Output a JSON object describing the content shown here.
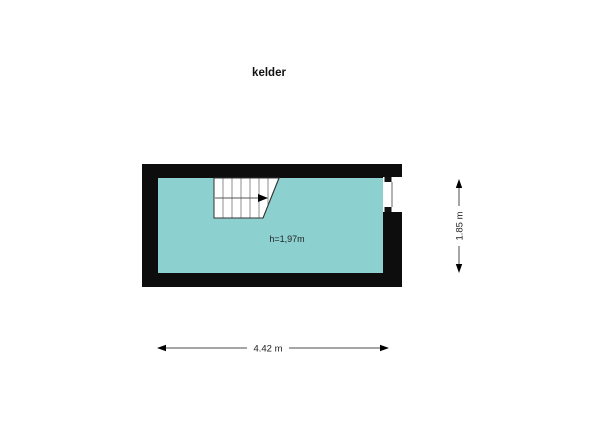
{
  "title": "kelder",
  "room": {
    "name": "kelder",
    "ceiling_height_label": "h=1,97m"
  },
  "dimensions": {
    "width_label": "4.42 m",
    "height_label": "1.85 m"
  },
  "colors": {
    "background": "#ffffff",
    "wall": "#0d0d0d",
    "floor": "#8dd0d0",
    "stair_fill": "#ffffff",
    "stair_outline": "#333333",
    "step_line": "#8f8f8f",
    "walkline": "#555555",
    "arrow": "#000000",
    "window_fill": "#ffffff",
    "window_glass": "#b3b3b3",
    "window_frame": "#111111",
    "dimension_line": "#4d4d4d",
    "label_text": "#222222"
  }
}
